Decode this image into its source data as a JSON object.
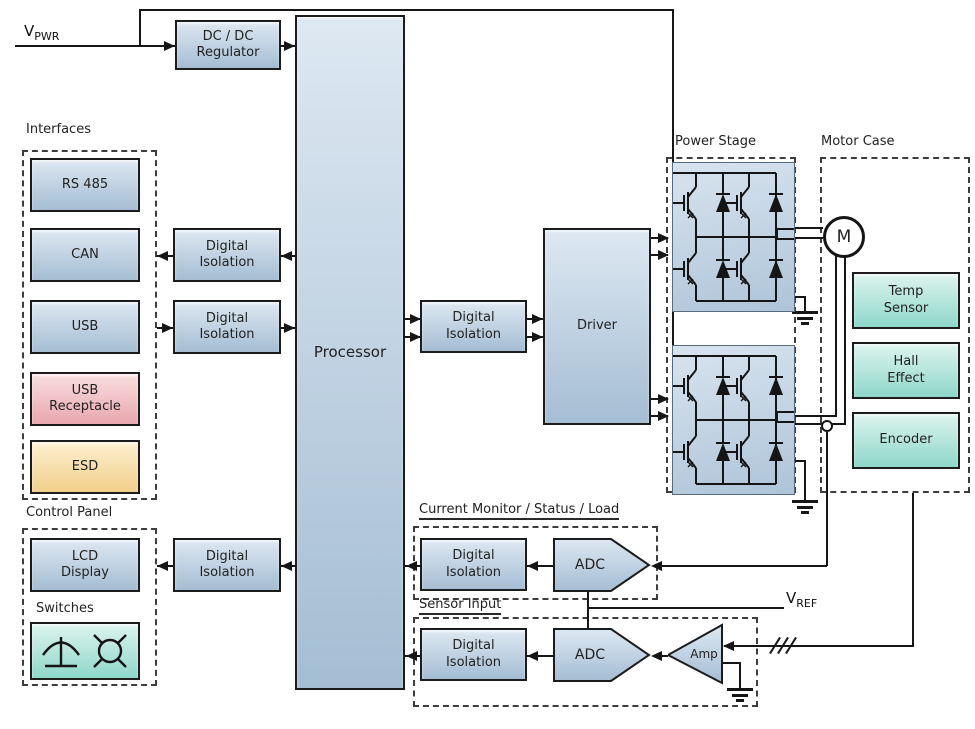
{
  "labels": {
    "v_pwr_base": "V",
    "v_pwr_sub": "PWR",
    "v_ref_base": "V",
    "v_ref_sub": "REF"
  },
  "groups": {
    "interfaces": "Interfaces",
    "control_panel": "Control Panel",
    "switches": "Switches",
    "power_stage": "Power Stage",
    "motor_case": "Motor Case",
    "current_monitor": "Current Monitor / Status / Load",
    "sensor_input": "Sensor Input"
  },
  "blocks": {
    "dcdc": "DC / DC\nRegulator",
    "rs485": "RS 485",
    "can": "CAN",
    "usb": "USB",
    "usb_receptacle": "USB\nReceptacle",
    "esd": "ESD",
    "digital_isolation": "Digital\nIsolation",
    "processor": "Processor",
    "driver": "Driver",
    "adc": "ADC",
    "amp": "Amp",
    "lcd_display": "LCD\nDisplay",
    "temp_sensor": "Temp\nSensor",
    "hall_effect": "Hall\nEffect",
    "encoder": "Encoder",
    "motor": "M"
  },
  "colors": {
    "line": "#161616",
    "dash": "#3d3d3d",
    "blue_top": "#dde8f2",
    "blue_bot": "#a5bdd3",
    "teal_top": "#ddf4ee",
    "teal_bot": "#8ed7c9",
    "pink_top": "#f9dee0",
    "pink_bot": "#e8a7ae",
    "yellow_top": "#fdf0d0",
    "yellow_bot": "#f1cf8a",
    "bridge_top": "#d8e4ef",
    "bridge_bot": "#aec4d8",
    "text": "#222222",
    "bg": "#ffffff"
  }
}
